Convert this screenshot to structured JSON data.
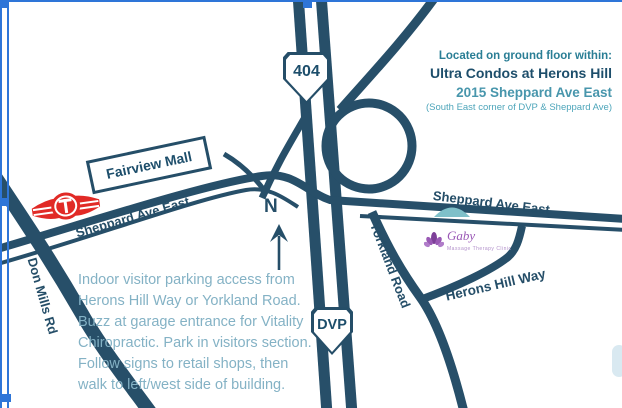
{
  "map": {
    "shield_404": "404",
    "shield_dvp": "DVP",
    "north_label": "N",
    "fairview_sign": "Fairview Mall",
    "streets": {
      "sheppard_west": "Sheppard Ave East",
      "sheppard_east": "Sheppard Ave East",
      "don_mills": "Don Mills Rd",
      "yorkland": "Yorkland Road",
      "herons_hill": "Herons Hill Way"
    }
  },
  "info_panel": {
    "line1": "Located on ground floor within:",
    "line2": "Ultra Condos at Herons Hill",
    "line3": "2015 Sheppard Ave East",
    "line4": "(South East corner of DVP & Sheppard Ave)"
  },
  "parking_note": {
    "lines": [
      "Indoor visitor parking access from",
      "Herons Hill Way or Yorkland Road.",
      "Buzz at garage entrance for Vitality",
      "Chiropractic. Park in visitors section.",
      "Follow signs to retail shops, then",
      "walk to left/west side of building."
    ]
  },
  "clinic_logo": {
    "name": "Gaby",
    "subtext": "Massage Therapy Clinic"
  },
  "colors": {
    "road": "#274f69",
    "heading_teal": "#2a7e95",
    "accent_teal": "#4896ac",
    "dark_navy": "#1d4e6b",
    "note_blue": "#84b2c5",
    "ttc_red": "#e12a26",
    "clinic_purple": "#9b59b6",
    "selection_blue": "#2e75d8",
    "dome_teal": "#7fc0c9"
  }
}
